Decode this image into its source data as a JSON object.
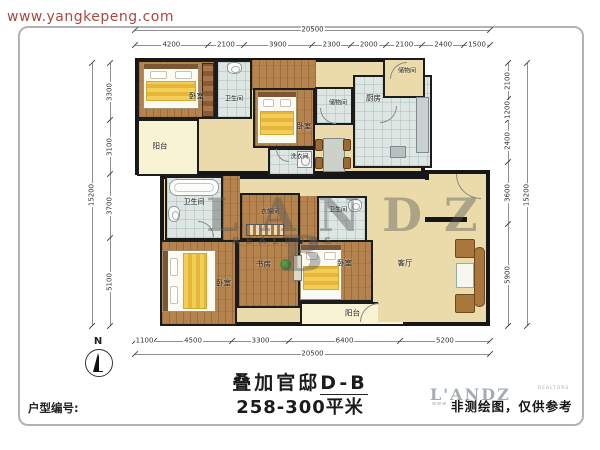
{
  "page": {
    "site_url": "www.yangkepeng.com",
    "north_label": "N"
  },
  "footer": {
    "title_prefix": "叠加官邸",
    "title_suffix": "D-B",
    "subtitle": "258-300平米",
    "unit_label": "户型编号:",
    "disclaimer": "非测绘图，仅供参考"
  },
  "logo": {
    "name": "L'ANDZ",
    "sub": "REALTORS",
    "url_fragment": "www"
  },
  "watermark": {
    "word": "LANDZ",
    "sub": "REALTORS",
    "big_letter": "B"
  },
  "plan": {
    "wall_color": "#161616",
    "base_blocks": [
      {
        "x": 135,
        "y": 58,
        "w": 290,
        "h": 117
      },
      {
        "x": 160,
        "y": 175,
        "w": 330,
        "h": 151
      },
      {
        "x": 425,
        "y": 170,
        "w": 65,
        "h": 156
      }
    ],
    "rooms": [
      {
        "id": "bedroom-1",
        "label": "卧室",
        "floor": "wood",
        "x": 137,
        "y": 60,
        "w": 79,
        "h": 59,
        "dx": 20,
        "dy": 6
      },
      {
        "id": "bath-1",
        "label": "卫生间",
        "floor": "bath",
        "x": 216,
        "y": 60,
        "w": 36,
        "h": 59,
        "fs": 6,
        "dy": 8
      },
      {
        "id": "hall-top",
        "floor": "wood",
        "x": 252,
        "y": 60,
        "w": 64,
        "h": 30,
        "wall": 0
      },
      {
        "id": "balcony-left",
        "label": "阳台",
        "floor": "balcony",
        "x": 137,
        "y": 119,
        "w": 62,
        "h": 57,
        "dx": -8,
        "dy": -2
      },
      {
        "id": "bedroom-2",
        "label": "卧室",
        "floor": "wood",
        "x": 253,
        "y": 88,
        "w": 62,
        "h": 60,
        "dx": 20,
        "dy": 8
      },
      {
        "id": "laundry",
        "label": "洗衣间",
        "floor": "bath",
        "x": 268,
        "y": 148,
        "w": 47,
        "h": 28,
        "fs": 6,
        "dx": 8,
        "dy": -6
      },
      {
        "id": "storage-1",
        "label": "储物间",
        "floor": "bath",
        "x": 315,
        "y": 87,
        "w": 38,
        "h": 38,
        "fs": 6,
        "dx": 4,
        "dy": -4
      },
      {
        "id": "kitchen",
        "label": "厨房",
        "floor": "bath",
        "x": 353,
        "y": 75,
        "w": 79,
        "h": 93,
        "dx": -19,
        "dy": -24
      },
      {
        "id": "storage-2",
        "label": "储物间",
        "floor": "tan",
        "x": 383,
        "y": 58,
        "w": 42,
        "h": 40,
        "fs": 6,
        "dx": 3,
        "dy": -8
      },
      {
        "id": "bath-2",
        "label": "卫生间",
        "floor": "bath",
        "x": 165,
        "y": 176,
        "w": 58,
        "h": 64,
        "fs": 7,
        "dy": -6
      },
      {
        "id": "hall-mid",
        "floor": "wood",
        "x": 223,
        "y": 176,
        "w": 17,
        "h": 64,
        "wall": 0
      },
      {
        "id": "cloak",
        "label": "衣帽间",
        "floor": "wood",
        "x": 240,
        "y": 193,
        "w": 60,
        "h": 47,
        "fs": 6,
        "dy": -6
      },
      {
        "id": "hall-mid2",
        "floor": "wood",
        "x": 300,
        "y": 196,
        "w": 17,
        "h": 54,
        "wall": 0
      },
      {
        "id": "bath-3",
        "label": "卫生间",
        "floor": "bath",
        "x": 317,
        "y": 196,
        "w": 50,
        "h": 54,
        "fs": 6,
        "dx": -4,
        "dy": -14
      },
      {
        "id": "study",
        "label": "书房",
        "floor": "wood",
        "x": 237,
        "y": 240,
        "w": 63,
        "h": 68,
        "dx": -5,
        "dy": -10
      },
      {
        "id": "bedroom-3",
        "label": "卧室",
        "floor": "wood",
        "x": 160,
        "y": 240,
        "w": 77,
        "h": 86,
        "dx": 25,
        "dy": 0
      },
      {
        "id": "bedroom-4",
        "label": "卧室",
        "floor": "wood",
        "x": 300,
        "y": 240,
        "w": 73,
        "h": 62,
        "dx": 8,
        "dy": -8
      },
      {
        "id": "balcony-bottom",
        "label": "阳台",
        "floor": "balcony",
        "x": 300,
        "y": 302,
        "w": 105,
        "h": 24,
        "dy": -1
      },
      {
        "id": "living",
        "label": "客厅",
        "floor": "tan",
        "x": 378,
        "y": 180,
        "w": 108,
        "h": 142,
        "wall": 0,
        "dx": -27,
        "dy": 12
      }
    ],
    "furniture": [
      {
        "t": "bed",
        "name": "bed",
        "x": 143,
        "y": 63,
        "w": 56,
        "h": 46,
        "o": "v"
      },
      {
        "t": "wardrobe",
        "name": "wardrobe",
        "x": 202,
        "y": 63,
        "w": 12,
        "h": 54
      },
      {
        "t": "toilet",
        "name": "toilet",
        "x": 227,
        "y": 62,
        "w": 15,
        "h": 12
      },
      {
        "t": "bed",
        "name": "bed",
        "x": 257,
        "y": 91,
        "w": 40,
        "h": 53,
        "o": "v"
      },
      {
        "t": "wm",
        "name": "washing-machine",
        "x": 297,
        "y": 151,
        "w": 15,
        "h": 17
      },
      {
        "t": "dining",
        "name": "dining-table",
        "x": 315,
        "y": 133,
        "w": 36,
        "h": 42
      },
      {
        "t": "counter",
        "name": "kitchen-counter",
        "x": 416,
        "y": 97,
        "w": 13,
        "h": 56
      },
      {
        "t": "graybox",
        "name": "kitchen-appliance",
        "x": 390,
        "y": 146,
        "w": 16,
        "h": 12
      },
      {
        "t": "tub",
        "name": "bathtub",
        "x": 169,
        "y": 179,
        "w": 50,
        "h": 17
      },
      {
        "t": "toilet",
        "name": "toilet",
        "x": 168,
        "y": 206,
        "w": 12,
        "h": 16
      },
      {
        "t": "toilet",
        "name": "toilet",
        "x": 348,
        "y": 199,
        "w": 14,
        "h": 13
      },
      {
        "t": "shelf",
        "name": "closet-shelf",
        "x": 246,
        "y": 224,
        "w": 38,
        "h": 12
      },
      {
        "t": "bed",
        "name": "bed",
        "x": 162,
        "y": 250,
        "w": 54,
        "h": 62,
        "o": "h"
      },
      {
        "t": "bed",
        "name": "bed",
        "x": 300,
        "y": 244,
        "w": 42,
        "h": 56,
        "o": "v"
      },
      {
        "t": "plant",
        "name": "plant",
        "x": 280,
        "y": 259,
        "w": 11,
        "h": 11
      },
      {
        "t": "cab",
        "name": "cabinet",
        "x": 293,
        "y": 255,
        "w": 9,
        "h": 26
      },
      {
        "t": "chairsq",
        "name": "armchair",
        "x": 455,
        "y": 239,
        "w": 20,
        "h": 19
      },
      {
        "t": "ctable",
        "name": "coffee-table",
        "x": 456,
        "y": 263,
        "w": 18,
        "h": 25
      },
      {
        "t": "chairsq",
        "name": "armchair",
        "x": 455,
        "y": 294,
        "w": 20,
        "h": 19
      },
      {
        "t": "sofa",
        "name": "sofa",
        "x": 474,
        "y": 247,
        "w": 11,
        "h": 60
      },
      {
        "t": "wallseg",
        "name": "wall-segment",
        "x": 425,
        "y": 217,
        "w": 42,
        "h": 5
      },
      {
        "t": "door",
        "name": "door-arc",
        "x": 320,
        "y": 108,
        "w": 16,
        "h": 16,
        "rot": 0
      },
      {
        "t": "door",
        "name": "door-arc",
        "x": 390,
        "y": 62,
        "w": 17,
        "h": 17,
        "rot": 90
      },
      {
        "t": "door",
        "name": "entry-door-arc",
        "x": 456,
        "y": 174,
        "w": 25,
        "h": 25,
        "rot": 0
      },
      {
        "t": "door",
        "name": "door-arc",
        "x": 360,
        "y": 303,
        "w": 19,
        "h": 19,
        "rot": 90
      },
      {
        "t": "door",
        "name": "door-arc",
        "x": 198,
        "y": 221,
        "w": 16,
        "h": 16,
        "rot": 180
      },
      {
        "t": "door",
        "name": "door-arc",
        "x": 380,
        "y": 106,
        "w": 17,
        "h": 17,
        "rot": 270
      },
      {
        "t": "door",
        "name": "door-arc",
        "x": 276,
        "y": 149,
        "w": 13,
        "h": 13,
        "rot": 0
      }
    ],
    "dimensions": [
      {
        "orient": "h",
        "pos": 30,
        "start": 135,
        "end": 490,
        "values": [
          20500
        ]
      },
      {
        "orient": "h",
        "pos": 45,
        "start": 135,
        "end": 490,
        "values": [
          4200,
          2100,
          3900,
          2300,
          2000,
          2100,
          2400,
          1500
        ]
      },
      {
        "orient": "h",
        "pos": 341,
        "start": 135,
        "end": 490,
        "values": [
          1100,
          4500,
          3300,
          6400,
          5200
        ]
      },
      {
        "orient": "h",
        "pos": 354,
        "start": 135,
        "end": 490,
        "values": [
          20500
        ]
      },
      {
        "orient": "v",
        "pos": 110,
        "start": 63,
        "end": 326,
        "values": [
          3300,
          3100,
          3700,
          5100
        ]
      },
      {
        "orient": "v",
        "pos": 92,
        "start": 63,
        "end": 326,
        "values": [
          15200
        ]
      },
      {
        "orient": "v",
        "pos": 508,
        "start": 63,
        "end": 326,
        "values": [
          2100,
          1200,
          2400,
          3600,
          5900
        ]
      },
      {
        "orient": "v",
        "pos": 527,
        "start": 63,
        "end": 326,
        "values": [
          15200
        ]
      }
    ]
  }
}
